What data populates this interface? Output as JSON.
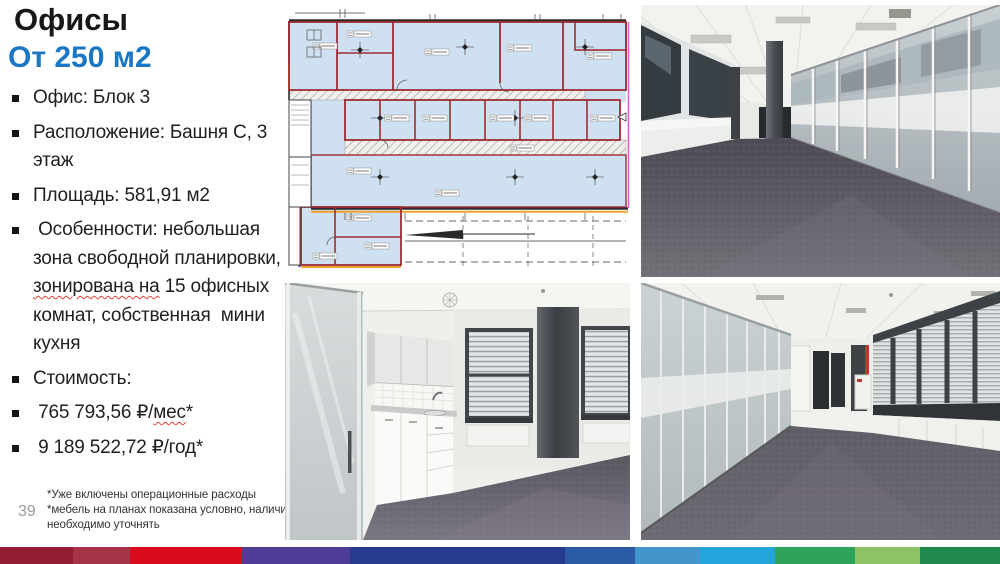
{
  "slide": {
    "title": "Офисы",
    "subtitle": "От 250 м2",
    "accent_color": "#1b77c4",
    "bullets": [
      {
        "pre": "Офис: Блок 3",
        "mark": "",
        "post": ""
      },
      {
        "pre": "Расположение: Башня С, 3 этаж",
        "mark": "",
        "post": ""
      },
      {
        "pre": "Площадь: 581,91 м2",
        "mark": "",
        "post": ""
      },
      {
        "pre": " Особенности: небольшая зона свободной планировки, ",
        "mark": "зонирована на",
        "post": " 15 офисных комнат, собственная  мини кухня"
      },
      {
        "pre": "Стоимость:",
        "mark": "",
        "post": ""
      },
      {
        "pre": " 765 793,56 ₽/",
        "mark": "мес",
        "post": "*"
      },
      {
        "pre": " 9 189 522,72 ₽/год*",
        "mark": "",
        "post": ""
      }
    ],
    "footnote_lines": [
      "*Уже включены операционные расходы",
      "*мебель на планах показана условно, наличие необходимо уточнять"
    ],
    "page_number": "39"
  },
  "footer_stripe": {
    "segments": [
      {
        "color": "#941D33",
        "width": 73
      },
      {
        "color": "#A53448",
        "width": 57
      },
      {
        "color": "#DC0A1E",
        "width": 112
      },
      {
        "color": "#4F3C98",
        "width": 108
      },
      {
        "color": "#283A8F",
        "width": 215
      },
      {
        "color": "#2B5BA7",
        "width": 70
      },
      {
        "color": "#4395CC",
        "width": 65
      },
      {
        "color": "#23A5DC",
        "width": 75
      },
      {
        "color": "#2EA45A",
        "width": 80
      },
      {
        "color": "#8FC167",
        "width": 65
      },
      {
        "color": "#1F8A4B",
        "width": 80
      }
    ]
  }
}
